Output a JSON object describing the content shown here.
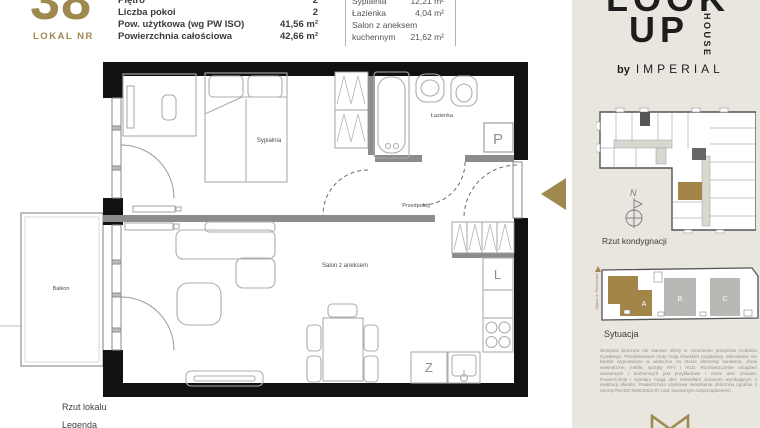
{
  "header": {
    "unit_number": "38",
    "unit_label": "LOKAL NR",
    "specs": [
      {
        "label": "Piętro",
        "value": "2"
      },
      {
        "label": "Liczba pokoi",
        "value": "2"
      },
      {
        "label": "Pow. użytkowa (wg PW ISO)",
        "value": "41,56 m²"
      },
      {
        "label": "Powierzchnia całościowa",
        "value": "42,66 m²"
      }
    ],
    "rooms": [
      {
        "label": "Sypialnia",
        "value": "12,21 m²"
      },
      {
        "label": "Łazienka",
        "value": "4,04 m²"
      },
      {
        "label": "Salon z aneksem",
        "value": ""
      },
      {
        "label": "kuchennym",
        "value": "21,62 m²"
      }
    ]
  },
  "plan": {
    "labels": {
      "sypialnia": "Sypialnia",
      "lazienka": "Łazienka",
      "przedpokoj": "Przedpokój",
      "salon": "Salon z aneksem",
      "balkon": "Balkon"
    },
    "markers": {
      "shaft": "P",
      "fridge": "L",
      "dishwasher": "Z"
    }
  },
  "footer": {
    "plan_caption": "Rzut lokalu",
    "legend_caption": "Legenda"
  },
  "sidebar": {
    "logo": {
      "line1": "LOOK",
      "line2": "UP",
      "vertical": "HOUSE",
      "by": "by",
      "brand": "IMPERIAL"
    },
    "floor_map": {
      "caption": "Rzut kondygnacji",
      "compass": "N"
    },
    "site_map": {
      "caption": "Sytuacja",
      "buildings": [
        "A",
        "B",
        "C"
      ],
      "street": "Wjazd ul. Piecewska"
    },
    "disclaimer": "Niniejsza broszura nie stanowi oferty w rozumieniu przepisów Kodeksu Cywilnego. Przedstawione rzuty mają charakter poglądowy. Mieszkanie nie będzie wyposażone w widoczne na rzucie elementy sanitarne, drzwi wewnętrzne, meble, sprzęty RTV i AGD. Rozmieszczenie urządzeń sanitarnych i kuchennych jest przykładowe i może ulec zmianie. Powierzchnie i wymiary mogą ulec niewielkim zmianom wynikającym z realizacji obiektu. Powierzchnia użytkowa mieszkania obliczona zgodnie z normą PN-ISO 9836:2022-07 oraz stosownym rozporządzeniem."
  },
  "colors": {
    "gold": "#a0894f",
    "panel_beige": "#e9e6e0",
    "wall_black": "#111111",
    "interior_wall_gray": "#8c8c8c"
  }
}
